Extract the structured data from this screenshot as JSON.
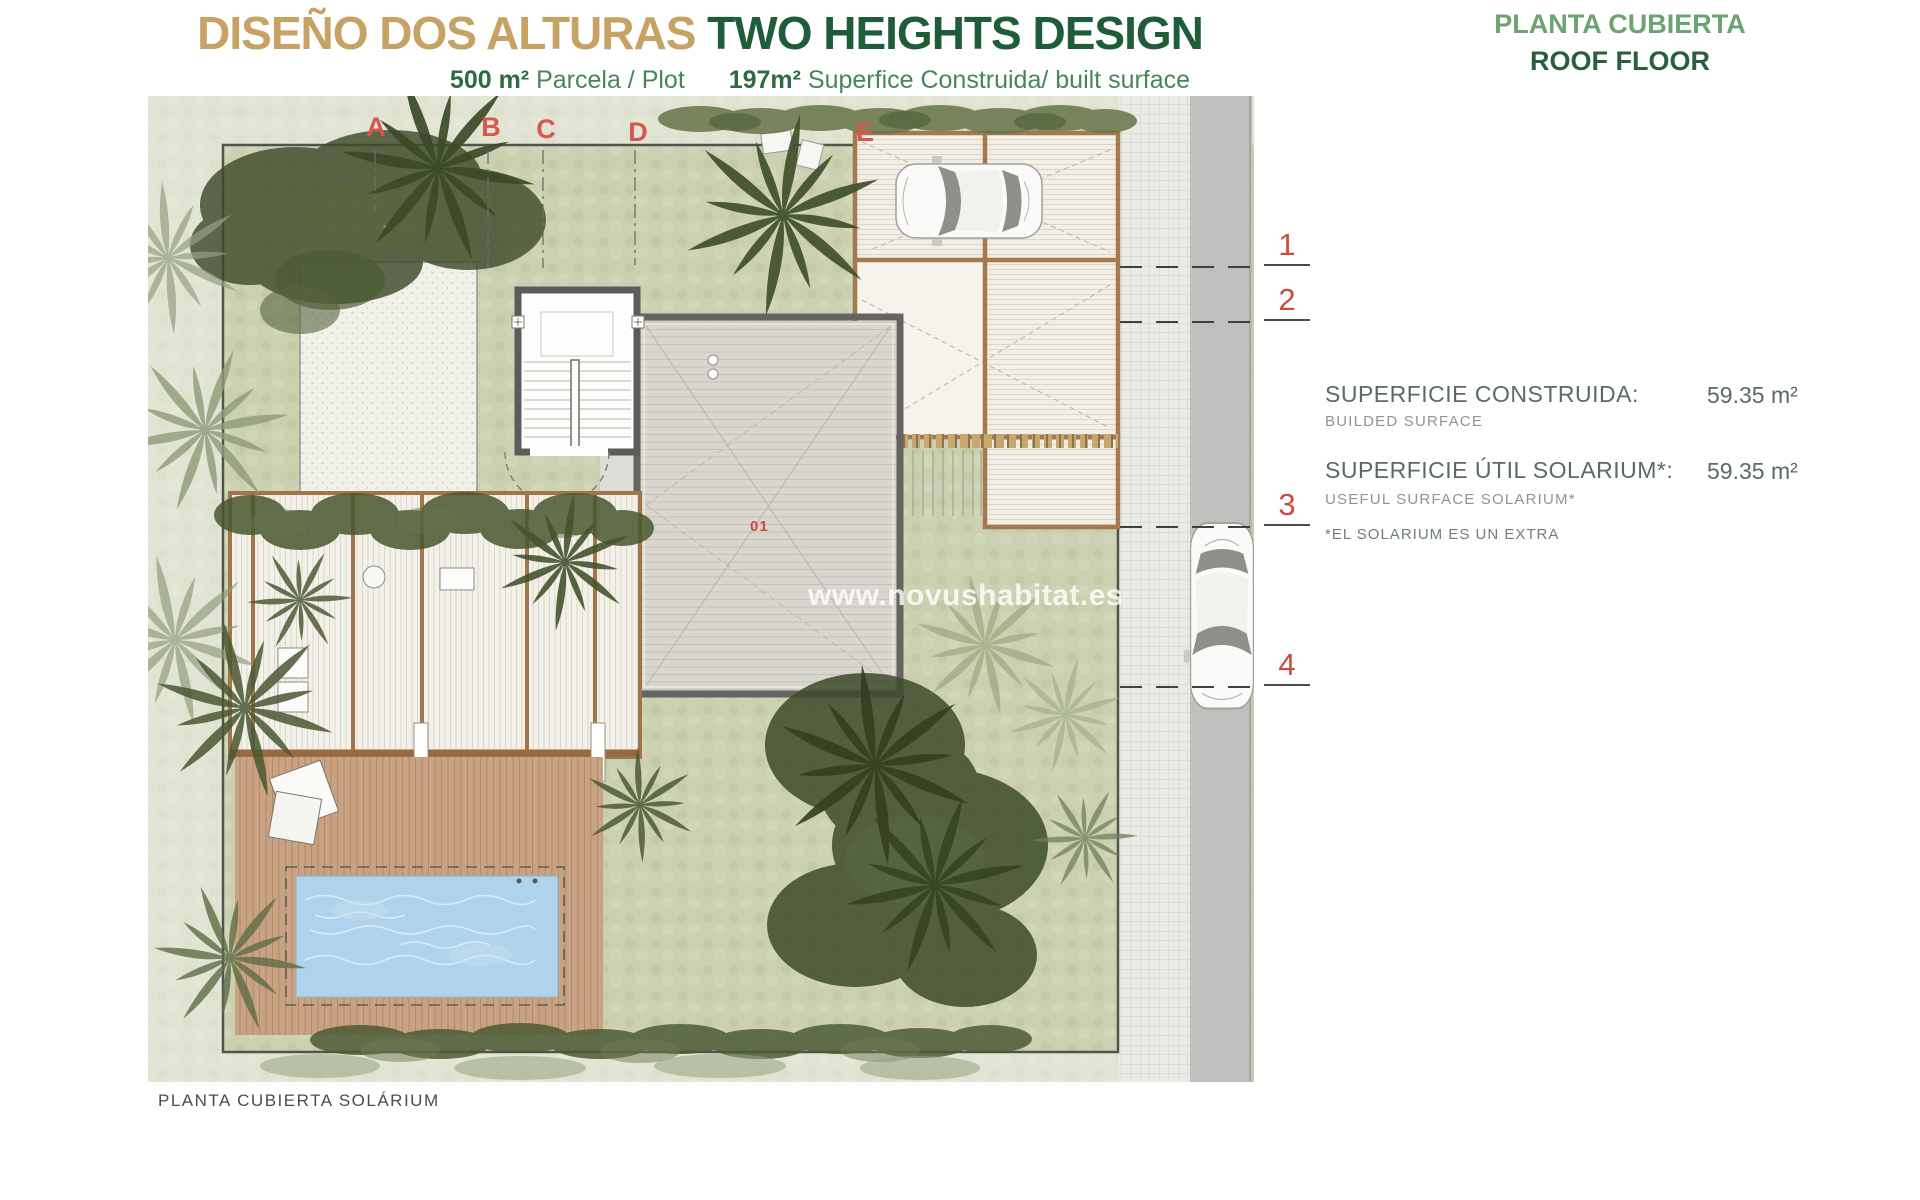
{
  "header": {
    "title_primary": "DISEÑO DOS ALTURAS",
    "title_secondary": "TWO HEIGHTS DESIGN",
    "subtitle": {
      "plot_value": "500 m²",
      "plot_label": "Parcela / Plot",
      "built_value": "197m²",
      "built_label": "Superfice Construida/ built surface"
    },
    "plan_title_es": "PLANTA CUBIERTA",
    "plan_title_en": "ROOF FLOOR"
  },
  "info_panel": {
    "rows": [
      {
        "label_es": "SUPERFICIE CONSTRUIDA:",
        "label_en": "BUILDED SURFACE",
        "value": "59.35 m²"
      },
      {
        "label_es": "SUPERFICIE ÚTIL SOLARIUM*:",
        "label_en": "USEFUL SURFACE SOLARIUM*",
        "value": "59.35 m²"
      }
    ],
    "footnote": "*EL SOLARIUM ES UN EXTRA"
  },
  "plan": {
    "grid_columns": [
      "A",
      "B",
      "C",
      "D",
      "E"
    ],
    "grid_rows": [
      "1",
      "2",
      "3",
      "4"
    ],
    "room_label": "01",
    "caption": "PLANTA CUBIERTA SOLÁRIUM",
    "watermark": "www.novushabitat.es"
  },
  "colors": {
    "title_tan": "#c7a265",
    "title_green": "#1f5c39",
    "subtitle_green": "#3c7c4f",
    "plan_title_light_green": "#6ca371",
    "plan_title_dark_green": "#2a5f3e",
    "info_text_gray": "#5b696b",
    "grid_red": "#d5584c",
    "pool_blue": "#aed3ea",
    "pergola_wood": "#a0754b",
    "deck_gray": "#d9d6cf"
  }
}
